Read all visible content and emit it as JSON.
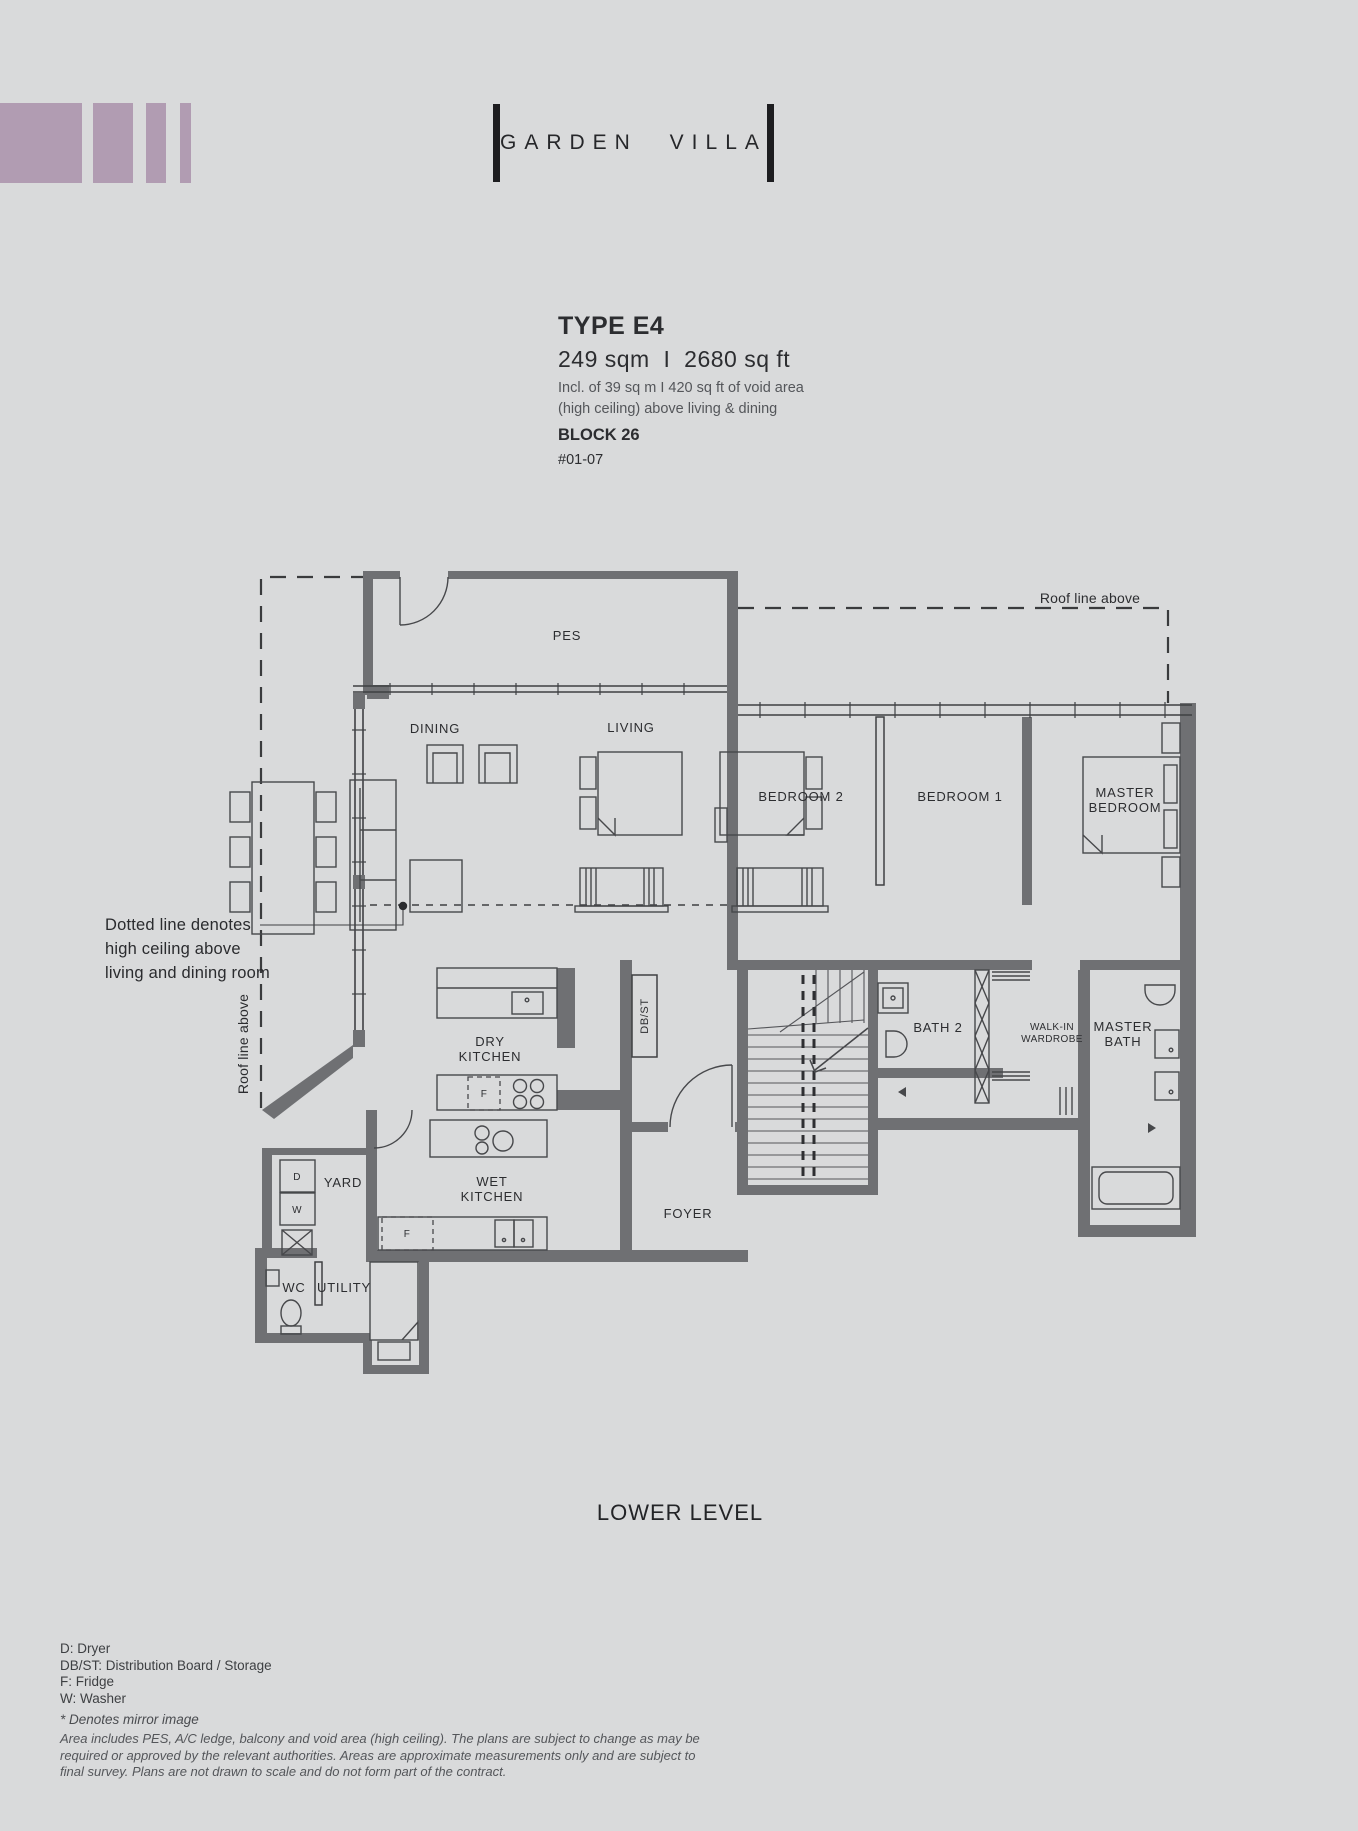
{
  "page": {
    "background": "#d9dadb",
    "logo_color": "#b19cb2"
  },
  "header": {
    "brand_name": "GARDEN VILLA"
  },
  "unit_info": {
    "type": "TYPE E4",
    "area": "249 sqm  I  2680 sq ft",
    "area_note_line1": "Incl. of 39 sq m I 420 sq ft of void area",
    "area_note_line2": "(high ceiling) above living & dining",
    "block": "BLOCK 26",
    "unit_number": "#01-07"
  },
  "floor_plan": {
    "level_label": "LOWER LEVEL",
    "rooms": {
      "pes": "PES",
      "dining": "DINING",
      "living": "LIVING",
      "bedroom2": "BEDROOM 2",
      "bedroom1": "BEDROOM 1",
      "master_bedroom": {
        "line1": "MASTER",
        "line2": "BEDROOM"
      },
      "dry_kitchen": {
        "line1": "DRY",
        "line2": "KITCHEN"
      },
      "wet_kitchen": {
        "line1": "WET",
        "line2": "KITCHEN"
      },
      "db_st": "DB/ST",
      "yard": "YARD",
      "wc": "WC",
      "utility": "UTILITY",
      "foyer": "FOYER",
      "bath2": "BATH 2",
      "walk_in_wardrobe": {
        "line1": "WALK-IN",
        "line2": "WARDROBE"
      },
      "master_bath": {
        "line1": "MASTER",
        "line2": "BATH"
      }
    },
    "appliance_marks": {
      "dryer": "D",
      "washer": "W",
      "fridge": "F"
    },
    "annotations": {
      "roof_line": "Roof line above",
      "high_ceiling_line1": "Dotted line denotes",
      "high_ceiling_line2": "high ceiling above",
      "high_ceiling_line3": "living and dining room"
    }
  },
  "legend": {
    "lines": [
      "D: Dryer",
      "DB/ST: Distribution Board / Storage",
      "F: Fridge",
      "W: Washer"
    ],
    "mirror_note": "* Denotes mirror image"
  },
  "disclaimer": {
    "lines": [
      "Area includes PES, A/C ledge, balcony and void area (high ceiling). The plans are subject to change as may be",
      "required or approved by the relevant authorities. Areas are approximate measurements only and are subject to",
      "final survey. Plans are not drawn to scale and do not form part of the contract."
    ]
  }
}
